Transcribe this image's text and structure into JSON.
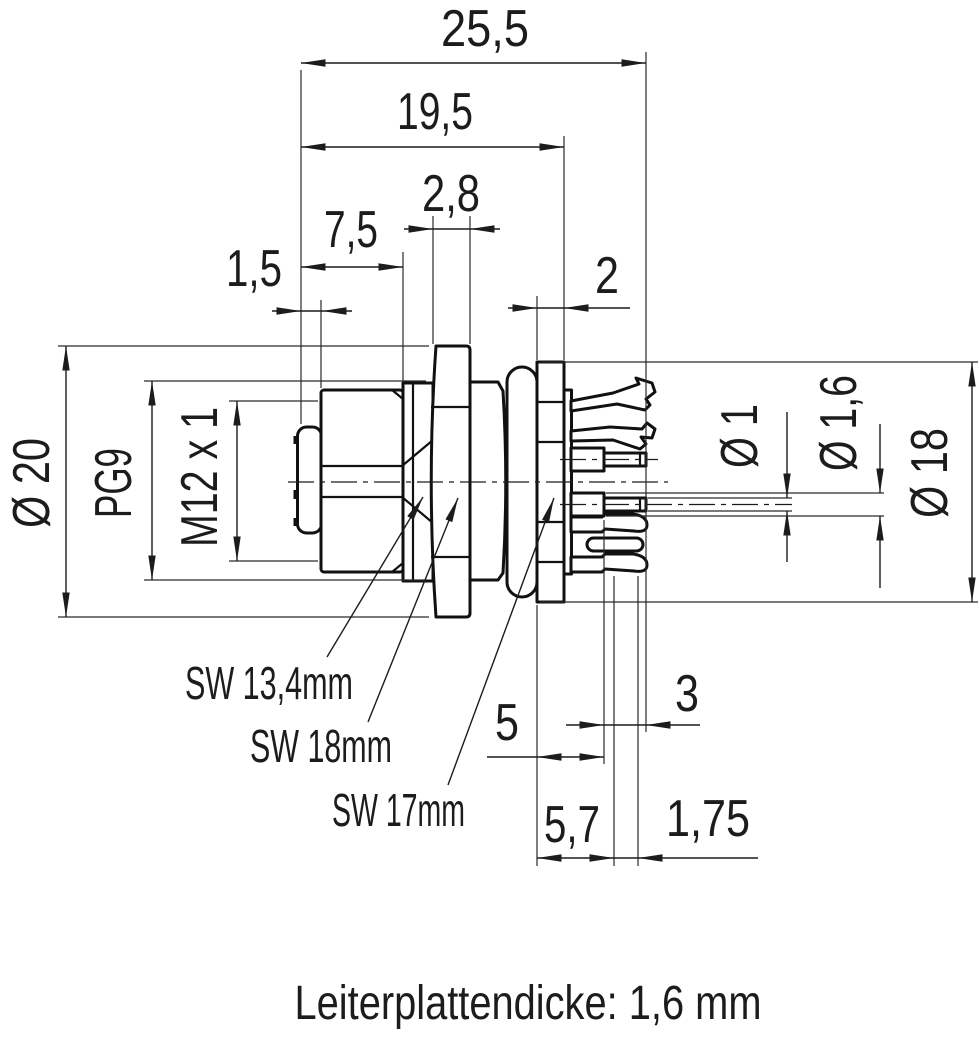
{
  "drawing": {
    "type": "technical-dimension-drawing",
    "subject": "M12 panel mount connector, side view with PCB contacts",
    "colors": {
      "line": "#1c1c1c",
      "background": "#ffffff"
    },
    "caption": "Leiterplattendicke: 1,6 mm",
    "dims_top": {
      "overall_length": {
        "label": "25,5",
        "value_mm": 25.5
      },
      "body_length": {
        "label": "19,5",
        "value_mm": 19.5
      },
      "nut_thickness": {
        "label": "2,8",
        "value_mm": 2.8
      },
      "hex_length": {
        "label": "7,5",
        "value_mm": 7.5
      },
      "front_band": {
        "label": "1,5",
        "value_mm": 1.5
      },
      "flange_thickness": {
        "label": "2",
        "value_mm": 2
      }
    },
    "dims_left": {
      "outer_diameter": {
        "label": "Ø 20",
        "value_mm": 20
      },
      "thread_rear": {
        "label": "PG9"
      },
      "thread_front": {
        "label": "M12 x 1"
      }
    },
    "dims_right": {
      "pin_diameter": {
        "label": "Ø 1",
        "value_mm": 1
      },
      "pin_shoulder_dia": {
        "label": "Ø 1,6",
        "value_mm": 1.6
      },
      "flange_diameter": {
        "label": "Ø 18",
        "value_mm": 18
      }
    },
    "dims_bottom": {
      "pin_shoulder_len": {
        "label": "5",
        "value_mm": 5
      },
      "pin_tip_len": {
        "label": "3",
        "value_mm": 3
      },
      "tail_len": {
        "label": "5,7",
        "value_mm": 5.7
      },
      "prong_width": {
        "label": "1,75",
        "value_mm": 1.75
      }
    },
    "wrench_sizes": {
      "sw_body": {
        "label": "SW 13,4mm"
      },
      "sw_nut_big": {
        "label": "SW 18mm"
      },
      "sw_nut_rear": {
        "label": "SW 17mm"
      }
    }
  }
}
